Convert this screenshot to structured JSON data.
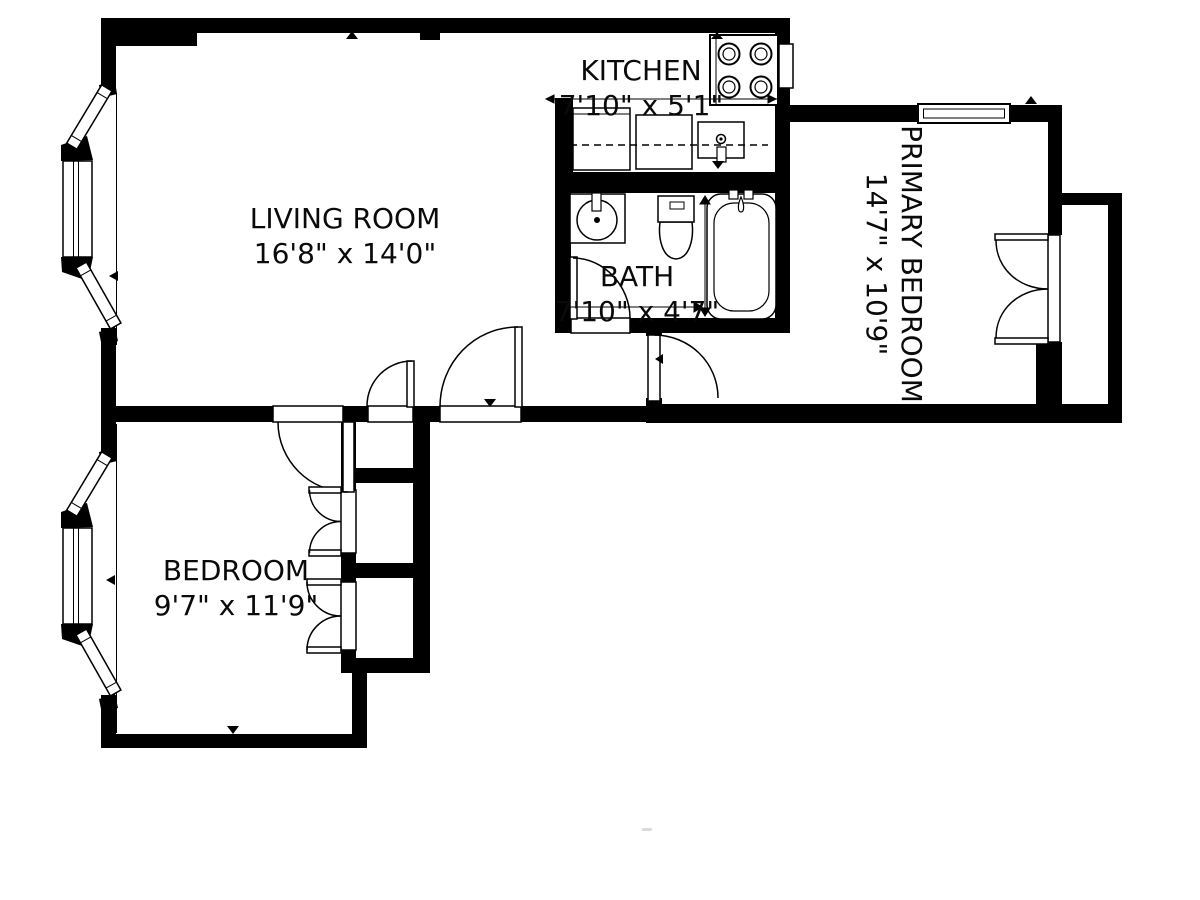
{
  "floor_plan": {
    "rooms": [
      {
        "id": "living-room",
        "name": "LIVING ROOM",
        "dimensions": "16'8\" x 14'0\""
      },
      {
        "id": "kitchen",
        "name": "KITCHEN",
        "dimensions": "7'10\" x 5'1\""
      },
      {
        "id": "bath",
        "name": "BATH",
        "dimensions": "7'10\" x 4'7\""
      },
      {
        "id": "primary-bedroom",
        "name": "PRIMARY BEDROOM",
        "dimensions": "14'7\" x 10'9\""
      },
      {
        "id": "bedroom",
        "name": "BEDROOM",
        "dimensions": "9'7\" x 11'9\""
      }
    ],
    "colors": {
      "walls": "#000000",
      "background": "#ffffff",
      "fixture_lines": "#000000"
    },
    "fixtures": [
      "stove",
      "refrigerator",
      "dishwasher",
      "kitchen-sink",
      "counter",
      "vanity-sink",
      "toilet",
      "bathtub",
      "bay-window-living",
      "bay-window-bedroom",
      "window-primary",
      "entry-door",
      "bedroom-door",
      "bath-door",
      "hall-door",
      "closet-doors-bedroom",
      "closet-doors-primary"
    ]
  }
}
